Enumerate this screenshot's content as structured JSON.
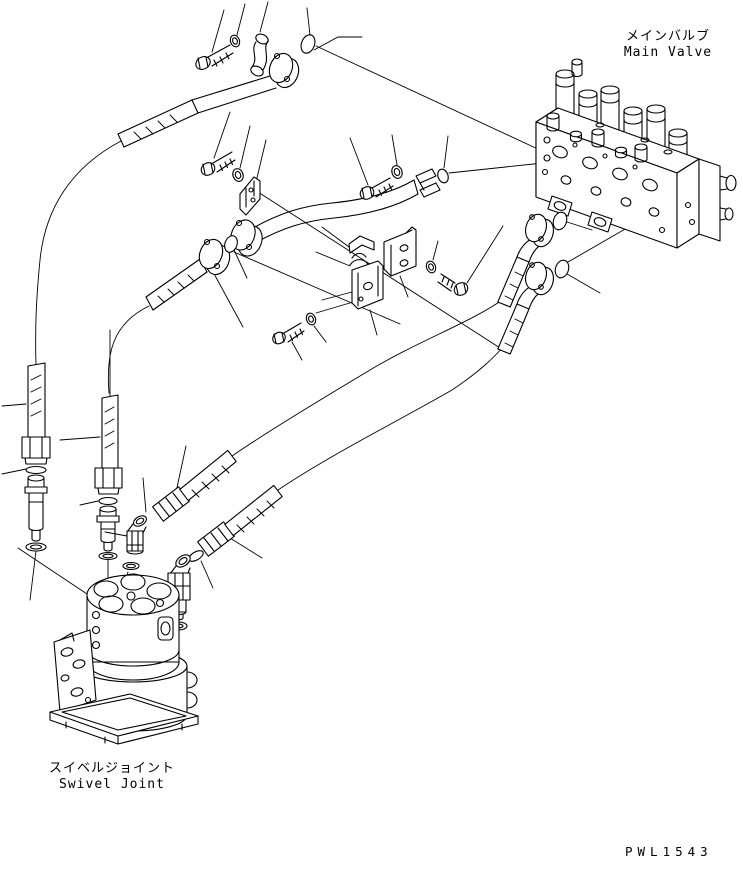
{
  "labels": {
    "main_valve": {
      "jp": "メインバルブ",
      "en": "Main Valve"
    },
    "swivel_joint": {
      "jp": "スイベルジョイント",
      "en": "Swivel Joint"
    },
    "drawing_code": "PWL1543"
  },
  "colors": {
    "line_color": "#000000",
    "background": "#ffffff"
  },
  "diagram": {
    "type": "exploded-parts-diagram",
    "subject": "hydraulic piping between main valve and swivel joint",
    "parts": [
      "main-valve",
      "swivel-joint",
      "inlet-tube",
      "return-tube",
      "suction-tube",
      "hydraulic-hose",
      "flange",
      "split-flange",
      "elbow-fitting",
      "vertical-pipe",
      "hex-nut",
      "nipple-fitting",
      "hose-clamp",
      "clamp-bracket",
      "bolt",
      "washer",
      "o-ring"
    ]
  }
}
